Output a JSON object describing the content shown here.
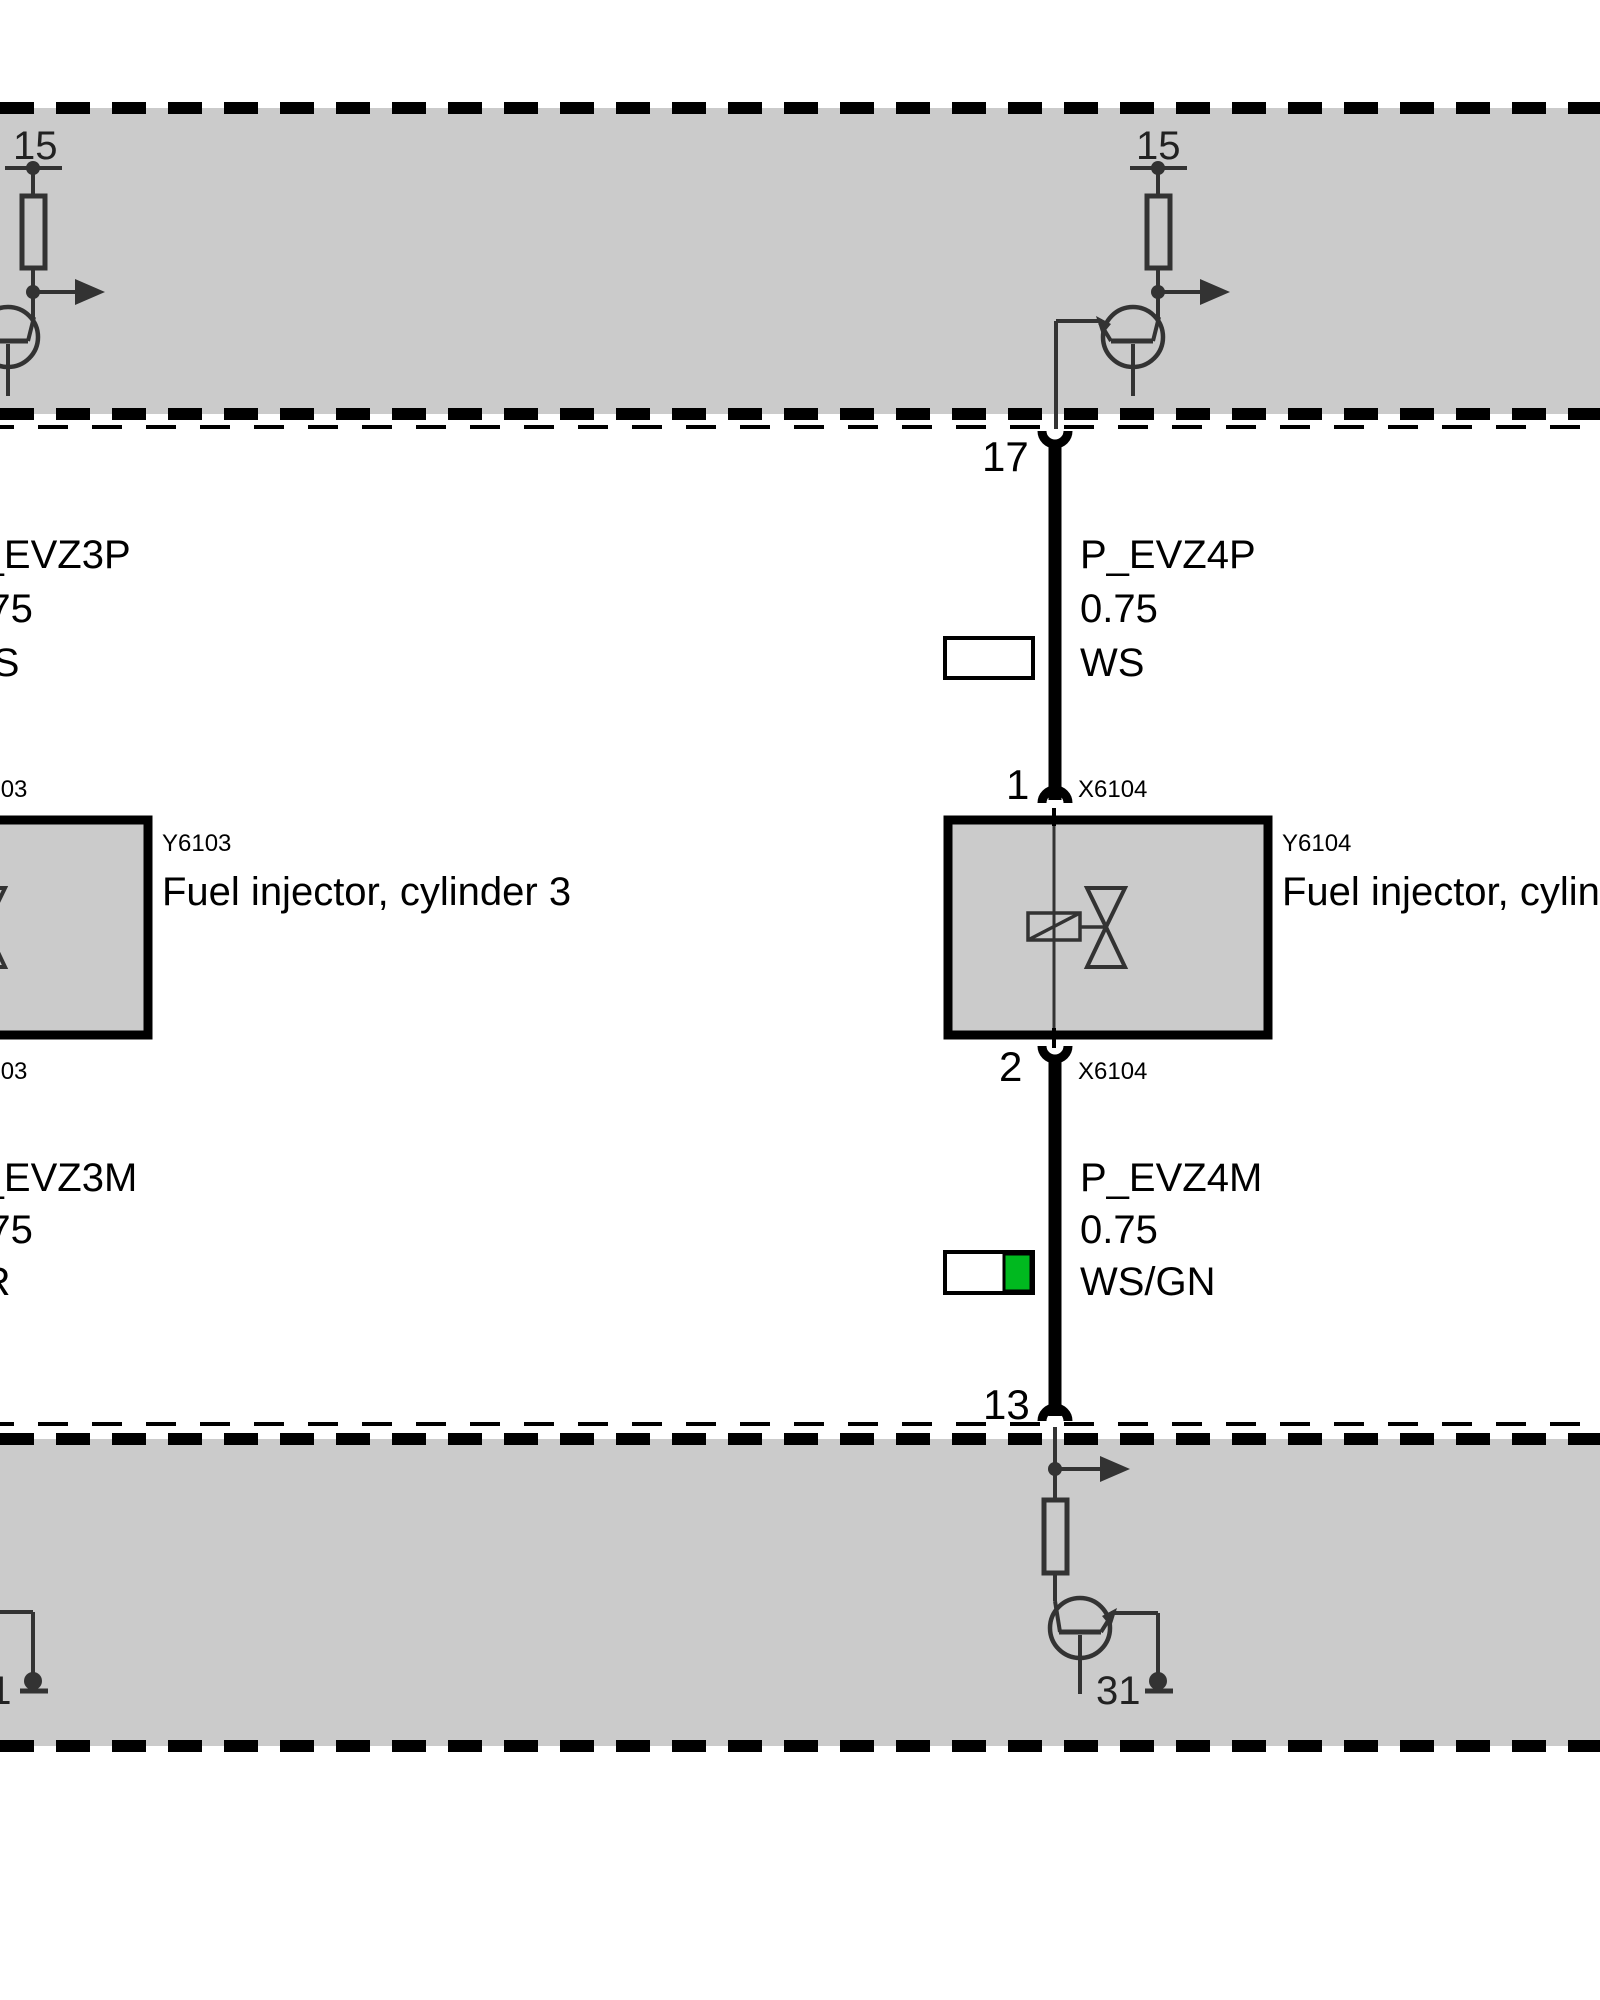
{
  "colors": {
    "band_gray": "#cbcbcb",
    "symbol_dark": "#333333",
    "wire_black": "#000000",
    "wire_white": "#ffffff",
    "wire_green": "#00b91f"
  },
  "top_module": {
    "left_terminal": "15",
    "right_terminal": "15"
  },
  "bottom_module": {
    "left_terminal": "31",
    "right_terminal": "31"
  },
  "columns": {
    "left": {
      "wire_top": {
        "name": "P_EVZ3P",
        "size": "0.75",
        "color_code": "WS"
      },
      "wire_bottom": {
        "name": "P_EVZ3M",
        "size": "0.75",
        "color_code": "BR"
      },
      "connector_top": "X6103",
      "connector_bottom": "X6103",
      "component_id": "Y6103",
      "component_name": "Fuel injector, cylinder 3"
    },
    "right": {
      "pin_ecu_top": "17",
      "pin_component_top": "1",
      "pin_component_bottom": "2",
      "pin_ecu_bottom": "13",
      "wire_top": {
        "name": "P_EVZ4P",
        "size": "0.75",
        "color_code": "WS"
      },
      "wire_bottom": {
        "name": "P_EVZ4M",
        "size": "0.75",
        "color_code": "WS/GN"
      },
      "connector_top": "X6104",
      "connector_bottom": "X6104",
      "component_id": "Y6104",
      "component_name": "Fuel injector, cylinder 4"
    }
  }
}
